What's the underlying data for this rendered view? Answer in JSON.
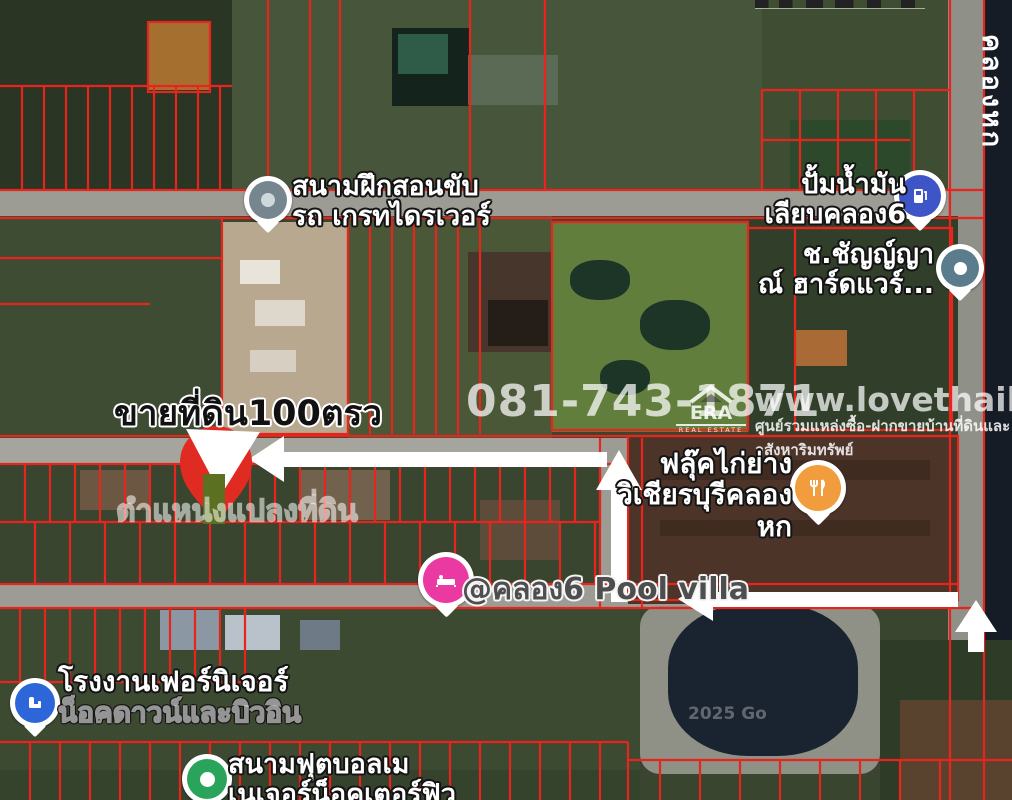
{
  "map": {
    "sale_listing": {
      "title": "ขายที่ดิน100ตรว",
      "plot_position_label": "ตำแหน่งแปลงที่ดิน"
    },
    "watermarks": {
      "phone": "081-743-1871",
      "site": "www.lovethaihome.com",
      "tagline": "ศูนย์รวมแหล่งซื้อ-ฝากขายบ้านที่ดินและอสังหาริมทรัพย์",
      "era": "ERA",
      "era_sub": "REAL ESTATE",
      "google_partial": "2025 Go"
    },
    "canal_label": "คลองหก",
    "pois": [
      {
        "id": "driving-school",
        "lines": [
          "สนามฝึกสอนขับ",
          "รถ เกรทไดรเวอร์"
        ],
        "icon": "generic-pin-icon",
        "color": "#75868e"
      },
      {
        "id": "gas-station",
        "lines": [
          "ปั้มน้ำมัน",
          "เลียบคลอง6"
        ],
        "icon": "gas-pump-icon",
        "color": "#3d55c6"
      },
      {
        "id": "hardware-store",
        "lines": [
          "ช.ชัญญ์ญา",
          "ณ์ ฮาร์ดแวร์..."
        ],
        "icon": "generic-pin-icon",
        "color": "#5b7c8c"
      },
      {
        "id": "restaurant",
        "lines": [
          "ฟลุ๊คไก่ย่าง",
          "วิเชียรบุรีคลองหก"
        ],
        "icon": "restaurant-icon",
        "color": "#f29d3d"
      },
      {
        "id": "pool-villa",
        "lines": [
          "@คลอง6 Pool villa"
        ],
        "icon": "lodging-icon",
        "color": "#ea3aa2"
      },
      {
        "id": "furniture-factory",
        "lines": [
          "โรงงานเฟอร์นิเจอร์",
          "น็อคดาวน์และบิวอิน"
        ],
        "icon": "furniture-icon",
        "color": "#2d66d9"
      },
      {
        "id": "football-field",
        "lines": [
          "สนามฟุตบอลเม",
          "เนเจอร์น็อคเตอร์ฟิว"
        ],
        "icon": "sports-icon",
        "color": "#2aa45a"
      }
    ],
    "colors": {
      "boundary": "#e8241d",
      "road": "#9c9c94",
      "arrow": "#ffffff",
      "canal": "#151c26"
    }
  }
}
